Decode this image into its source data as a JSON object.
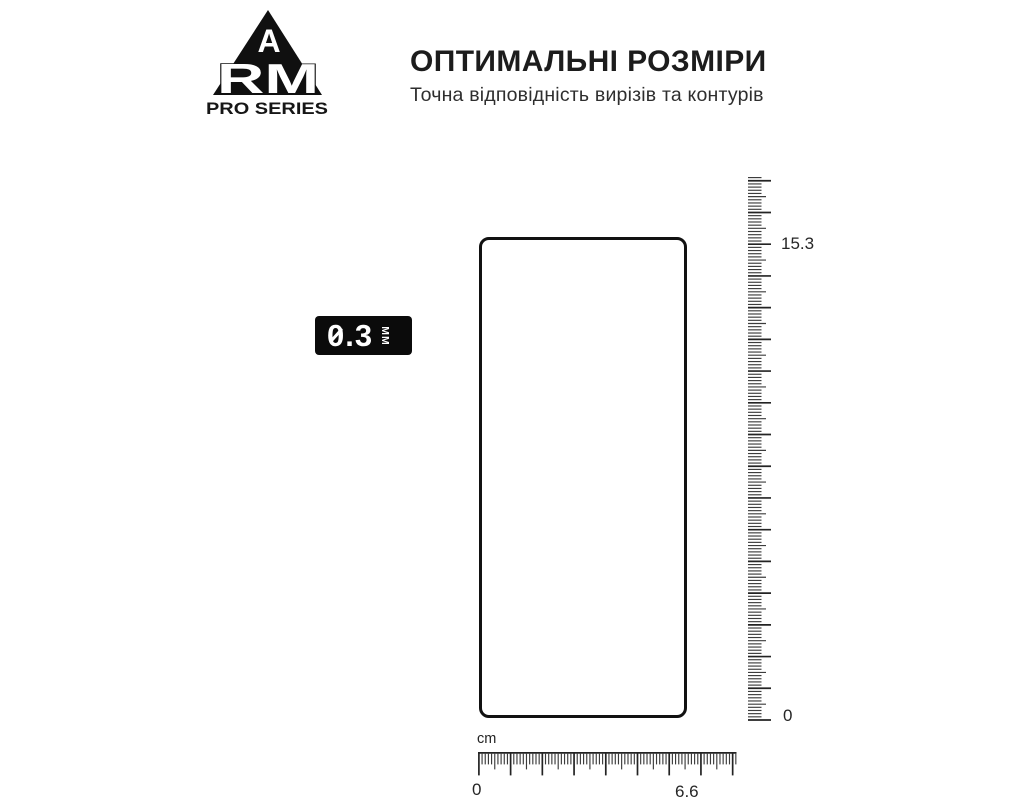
{
  "logo": {
    "letter_a": "A",
    "letters_rm": "RM",
    "series_label": "PRO SERIES"
  },
  "header": {
    "title": "ОПТИМАЛЬНІ РОЗМІРИ",
    "subtitle": "Точна відповідність вирізів та контурів"
  },
  "thickness_badge": {
    "value": "0.3",
    "unit": "ММ"
  },
  "diagram": {
    "protector": {
      "height_cm": "15.3",
      "width_cm": "6.6",
      "thickness_mm": "0.3"
    },
    "vertical_ruler": {
      "top_label": "15.3",
      "bottom_label": "0"
    },
    "horizontal_ruler": {
      "unit_label": "cm",
      "left_label": "0",
      "right_label": "6.6"
    }
  },
  "colors": {
    "ink": "#1c1c1c",
    "subtle": "#2e2e2e",
    "tick": "#3c3c3c",
    "badge_bg": "#0b0b0b",
    "badge_text": "#ffffff",
    "bg": "#ffffff"
  }
}
